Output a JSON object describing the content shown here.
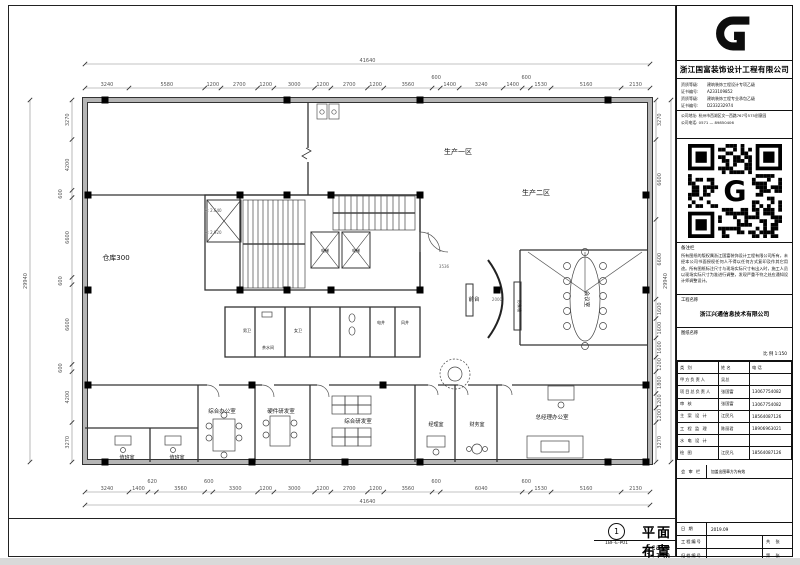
{
  "title_block": {
    "company": "浙江国富装饰设计工程有限公司",
    "creds": [
      {
        "k": "资质等级:",
        "v": "建筑装饰工程设计专项乙级"
      },
      {
        "k": "证书编号:",
        "v": "A233109852"
      },
      {
        "k": "资质等级:",
        "v": "建筑装饰工程专业承包乙级"
      },
      {
        "k": "证书编号:",
        "v": "D233232974"
      }
    ],
    "address": "公司地址: 杭州市西湖区文一西路767号575创意园",
    "phone": "公司电话: 0571 — 89850406",
    "remark_title": "备注栏",
    "remark": "所有图纸的版权属浙江国富装饰设计工程有限公司所有，未经本公司书面授权任何人不得以任何方式复印及作其它用途。所有图纸标注尺寸与现场实际尺寸有出入时，施工人员以现场实际尺寸为准进行调整，发现严重不符之处应通知设计师调整设计。",
    "project_label": "工程名称",
    "project_name": "浙江兴通信息技术有限公司",
    "drawing_label": "图纸名称",
    "scale_note": "比 例  1:150",
    "table": {
      "headers": [
        "类  别",
        "姓  名",
        "电  话"
      ],
      "rows": [
        [
          "甲方负责人",
          "吴总",
          ""
        ],
        [
          "项目总负责人",
          "张国富",
          "13067754082"
        ],
        [
          "审    核",
          "张国富",
          "13067754082"
        ],
        [
          "主 案 设 计",
          "江民凡",
          "18564087126"
        ],
        [
          "工 程 监 理",
          "陈丽君",
          "18906963021"
        ],
        [
          "水 电 设 计",
          "",
          ""
        ],
        [
          "绘    图",
          "江民凡",
          "18564087126"
        ]
      ]
    },
    "review_label": "会 审 栏",
    "review_note": "加盖出图章方为有效",
    "date_label": "日  期",
    "date_value": "2019.09",
    "proj_no_label": "工程编号",
    "sheets_total": "共  张",
    "file_no_label": "归档编号",
    "sheet_no": "第  张"
  },
  "footer": {
    "sheet_index": "1",
    "drawing_code": "1BF-E-P01",
    "drawing_title": "平面布置图",
    "scale_text": "Scale 1:150"
  },
  "plan": {
    "labels": {
      "area1": "生产一区",
      "area2": "生产二区",
      "warehouse": "仓库300",
      "reception": "前台",
      "feature_wall": "形象墙",
      "meeting": "会议室",
      "office_general": "综合办公室",
      "office_hardware": "硬件研发室",
      "office_rnd": "综合研发室",
      "manager": "经理室",
      "finance": "财务室",
      "gm_office": "总经理办公室",
      "duty1": "值班室",
      "duty2": "值班室",
      "wc_m": "男卫",
      "wc_f": "女卫",
      "tea": "茶水间",
      "elec_shaft": "电井",
      "air_shaft": "风井",
      "elevator1": "电梯",
      "elevator2": "电梯",
      "level1": "H: 2.640",
      "level2": "H: 2.920"
    },
    "dims": {
      "top": [
        3240,
        5580,
        1200,
        2700,
        1200,
        3000,
        1200,
        2700,
        1200,
        3560,
        600,
        1400,
        3240,
        1400,
        600,
        1530,
        5160,
        2130
      ],
      "bottom": [
        3240,
        1400,
        620,
        3560,
        600,
        3300,
        1200,
        3000,
        1200,
        2700,
        1200,
        3560,
        600,
        6040,
        600,
        1530,
        5160,
        2130
      ],
      "left": [
        3270,
        4200,
        600,
        6600,
        600,
        6600,
        600,
        4200,
        3270
      ],
      "right": [
        3270,
        6600,
        6600,
        1600,
        1600,
        1600,
        1200,
        1800,
        1200,
        1200,
        3270
      ],
      "top_total": "41640",
      "bottom_total": "41640",
      "left_total": "29940",
      "right_total": "29940",
      "corridor": "3536",
      "desk": "2000"
    }
  }
}
